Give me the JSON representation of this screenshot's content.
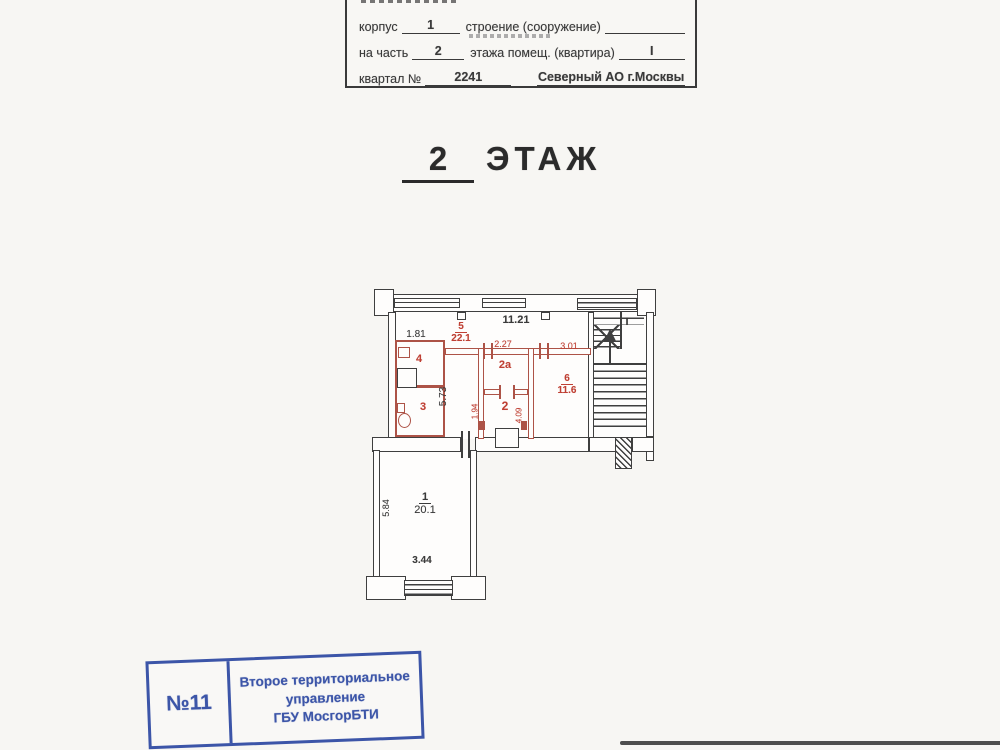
{
  "form": {
    "line1": {
      "label_korpus": "корпус",
      "value_korpus": "1",
      "label_stroenie": "строение (сооружение)"
    },
    "line2": {
      "label_na_chast": "на часть",
      "value_na_chast": "2",
      "label_etazha": "этажа помещ. (квартира)",
      "value_kvartira": "I"
    },
    "line3": {
      "label_kvartal": "квартал №",
      "value_kvartal": "2241",
      "value_okrug": "Северный АО г.Москвы"
    }
  },
  "title": {
    "floor_number": "2",
    "floor_word": "ЭТАЖ"
  },
  "plan": {
    "labels": {
      "dim_top": "11.21",
      "dim_left_top": "1.81",
      "dim_corridor": "5.73",
      "room5_num": "5",
      "room5_area": "22.1",
      "dim_2a_width": "2.27",
      "room2a_num": "2а",
      "dim_6_width": "3.01",
      "room6_num": "6",
      "room6_area": "11.6",
      "room2_num": "2",
      "dim_2_left": "1.94",
      "dim_2_right": "4.09",
      "room4_num": "4",
      "room3_num": "3",
      "stair_num": "I",
      "room1_num": "1",
      "room1_area": "20.1",
      "dim_room1_height": "5.84",
      "dim_room1_width": "3.44"
    }
  },
  "stamp": {
    "number": "№11",
    "line1": "Второе территориальное",
    "line2": "управление",
    "line3": "ГБУ МосгорБТИ"
  },
  "colors": {
    "plan_red": "#ad5347",
    "plan_black": "#3f3f3f",
    "stamp_blue": "#3c55a8",
    "label_red": "#bf4034"
  }
}
